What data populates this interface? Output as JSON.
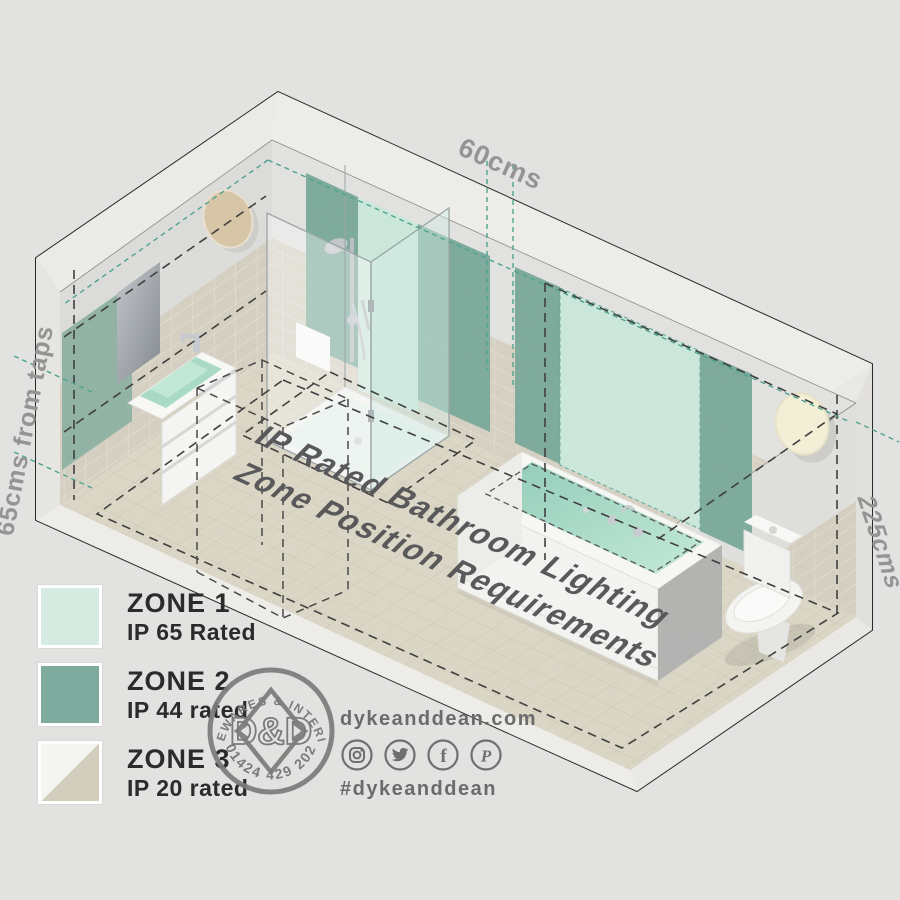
{
  "title": {
    "line1": "IP Rated Bathroom Lighting",
    "line2": "Zone Position Requirements"
  },
  "dimensions": {
    "top": "60cms",
    "left": "65cms from taps",
    "right": "225cms"
  },
  "legend": {
    "items": [
      {
        "zone": "ZONE 1",
        "rating": "IP 65 Rated",
        "color": "#d5ebe2"
      },
      {
        "zone": "ZONE 2",
        "rating": "IP 44 rated",
        "color": "#7fab9e"
      },
      {
        "zone": "ZONE 3",
        "rating": "IP 20 rated",
        "color_top": "#f5f5f2",
        "color_bottom": "#d2cdbd"
      }
    ]
  },
  "stamp": {
    "top_text": "HOMEWARES & INTERIORS",
    "center_text": "D&D",
    "bottom_text": "01424 429 202"
  },
  "footer": {
    "website": "dykeanddean.com",
    "hashtag": "#dykeanddean",
    "social_icons": [
      "instagram-icon",
      "twitter-icon",
      "facebook-icon",
      "pinterest-icon"
    ]
  },
  "colors": {
    "background": "#e2e2e1",
    "zone1_mint": "#cdeadd",
    "zone2_green": "#7cab9c",
    "zone3_tile": "#d6d1c2",
    "teal_dash": "#4aa390",
    "dim_text": "#949494",
    "floor_text": "#59595b",
    "stamp_gray": "#7b7b7b"
  }
}
